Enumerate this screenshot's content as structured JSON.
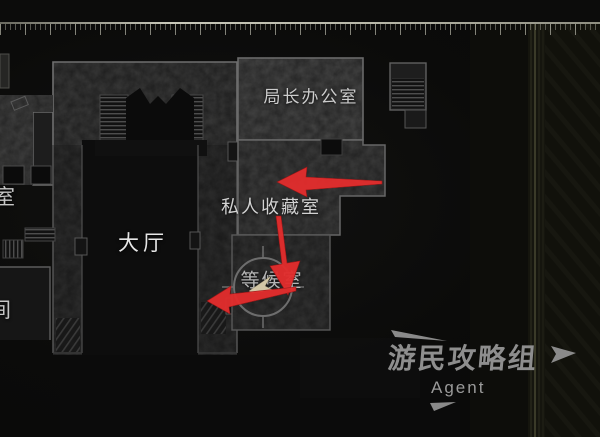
{
  "map_labels": {
    "chief_office": "局长办公室",
    "private_collection": "私人收藏室",
    "main_hall": "大厅",
    "waiting_room": "等候室",
    "left_room_partial": "室",
    "left_lower_room_partial": "间"
  },
  "marker": {
    "shape": "compass-circle-with-player-pointer",
    "pointer_color": "#d3c7a6",
    "ring_color": "#757575"
  },
  "arrows": {
    "color": "#e22d2d",
    "items": [
      {
        "id": "arrow-collection-left",
        "direction": "left"
      },
      {
        "id": "arrow-collection-down",
        "direction": "down"
      },
      {
        "id": "arrow-waiting-left",
        "direction": "left"
      }
    ]
  },
  "watermark": {
    "title": "游民攻略组",
    "subtitle": "Agent",
    "color": "#8e8e8e"
  },
  "colors": {
    "background": "#0b0b0a",
    "wall_outline": "#6f6f6f",
    "room_fill": "#202020",
    "accent_red": "#e22d2d"
  }
}
